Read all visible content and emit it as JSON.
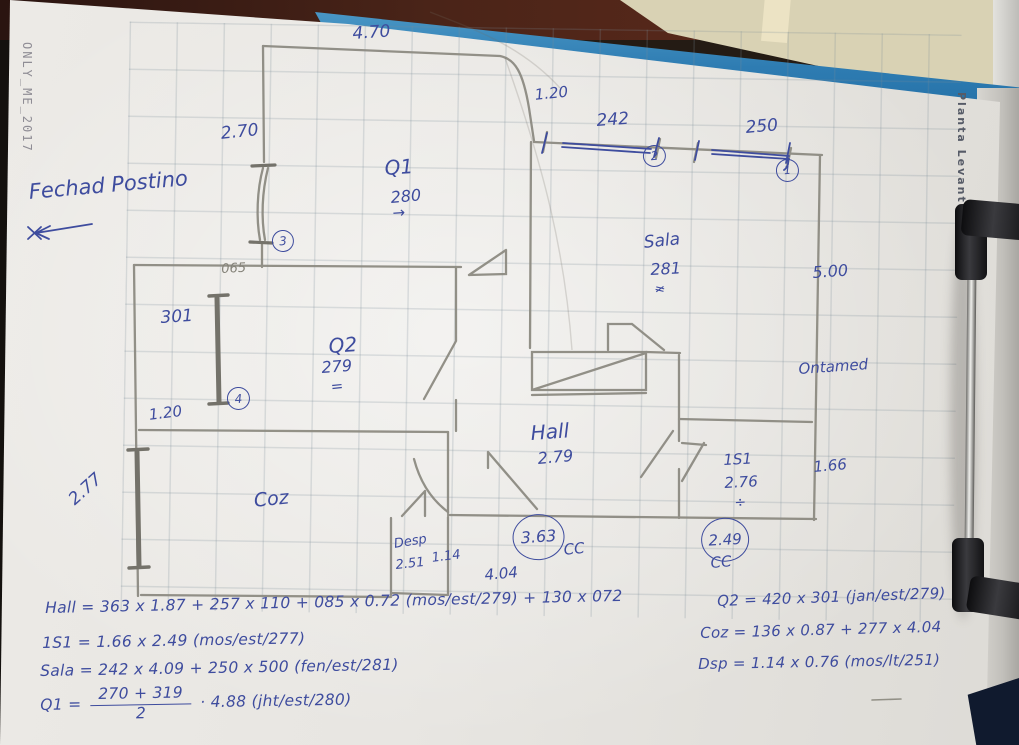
{
  "watermarks": {
    "left": "ONLY_ME_2017",
    "right": "Planta Levantamento"
  },
  "notes": {
    "header_note": "Fechad Postino",
    "right_note": "Ontamed"
  },
  "plan_labels": {
    "dim_470": "4.70",
    "dim_270": "2.70",
    "circ_3": "3",
    "dim_120_top": "1.20",
    "dim_242": "242",
    "circ_2": "2",
    "dim_250": "250",
    "circ_1": "1",
    "room_q1": "Q1",
    "q1_height": "280",
    "q1_arrow": "→",
    "room_sala": "Sala",
    "sala_height": "281",
    "sala_mark": "≠",
    "dim_500": "5.00",
    "dim_065": "065",
    "dim_301": "301",
    "room_q2": "Q2",
    "q2_height": "279",
    "q2_mark": "=",
    "circ_4": "4",
    "dim_120_left": "1.20",
    "room_hall": "Hall",
    "hall_height": "2.79",
    "dim_277": "2.77",
    "room_coz": "Coz",
    "ref_363": "3.63",
    "cc_left": "CC",
    "room_is1": "1S1",
    "is1_height": "2.76",
    "is1_mark": "÷",
    "dim_166": "1.66",
    "ref_249": "2.49",
    "cc_right": "CC",
    "room_desp": "Desp",
    "desp_height": "2.51",
    "dim_114": "1.14",
    "dim_404": "4.04"
  },
  "formulas": {
    "hall": "Hall = 363 x 1.87 + 257 x 110 + 085 x 0.72 (mos/est/279) + 130 x 072",
    "is1": "1S1 = 1.66 x 2.49 (mos/est/277)",
    "sala": "Sala = 242 x 4.09 + 250 x 500 (fen/est/281)",
    "q1_prefix": "Q1 =",
    "q1_num": "270 + 319",
    "q1_den": "2",
    "q1_suffix": "· 4.88 (jht/est/280)",
    "q2": "Q2 = 420 x 301 (jan/est/279)",
    "coz": "Coz = 136 x 0.87 + 277 x 4.04",
    "dsp": "Dsp = 1.14 x 0.76 (mos/lt/251)"
  }
}
